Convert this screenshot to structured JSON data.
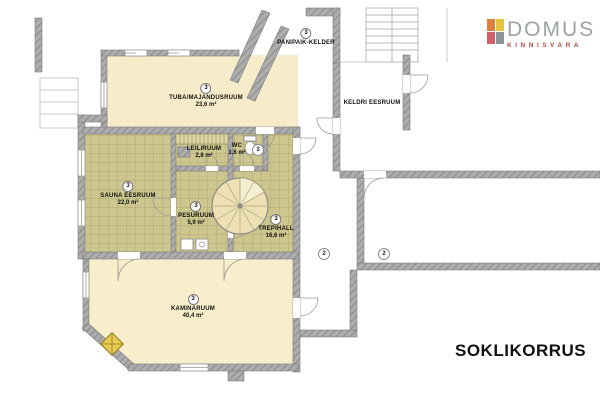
{
  "plan": {
    "floor_label": "SOKLIKORRUS"
  },
  "logo": {
    "name": "DOMUS",
    "sub": "KINNISVARA"
  },
  "rooms": [
    {
      "key": "tuba",
      "label": "TUBA/MAJANDUSRUUM",
      "area": "23,6 m²",
      "badge": "3"
    },
    {
      "key": "panipaik",
      "label": "PANIPAIK-KELDER",
      "badge": "3"
    },
    {
      "key": "keldri",
      "label": "KELDRI EESRUUM"
    },
    {
      "key": "sauna",
      "label": "SAUNA EESRUUM",
      "area": "22,0 m²",
      "badge": "3"
    },
    {
      "key": "leiliruum",
      "label": "LEILIRUUM",
      "area": "2,8 m²"
    },
    {
      "key": "wc",
      "label": "WC",
      "area": "1,6 m²",
      "badge": "3"
    },
    {
      "key": "pesuruum",
      "label": "PESURUUM",
      "area": "5,9 m²",
      "badge": "3"
    },
    {
      "key": "trepihall",
      "label": "TREPIHALL",
      "area": "16,6 m²",
      "badge": "3"
    },
    {
      "key": "kaminaruum",
      "label": "KAMINARUUM",
      "area": "40,4 m²",
      "badge": "3"
    }
  ],
  "markers": [
    {
      "value": "2"
    },
    {
      "value": "2"
    }
  ],
  "colors": {
    "wall": "#a8a8a8",
    "wall_hatch": "#8f8f8f",
    "tile": "#cdc68e",
    "tile_line": "#b2aa72",
    "room_cream": "#f6ecca",
    "stair_fill": "#ece0b4",
    "logo_orange": "#df7f3e",
    "logo_yellow": "#e5c53e",
    "logo_red": "#d2606a",
    "logo_gray": "#8f949a",
    "logo_text": "#9ba2a6",
    "logo_sub": "#b5494f"
  }
}
